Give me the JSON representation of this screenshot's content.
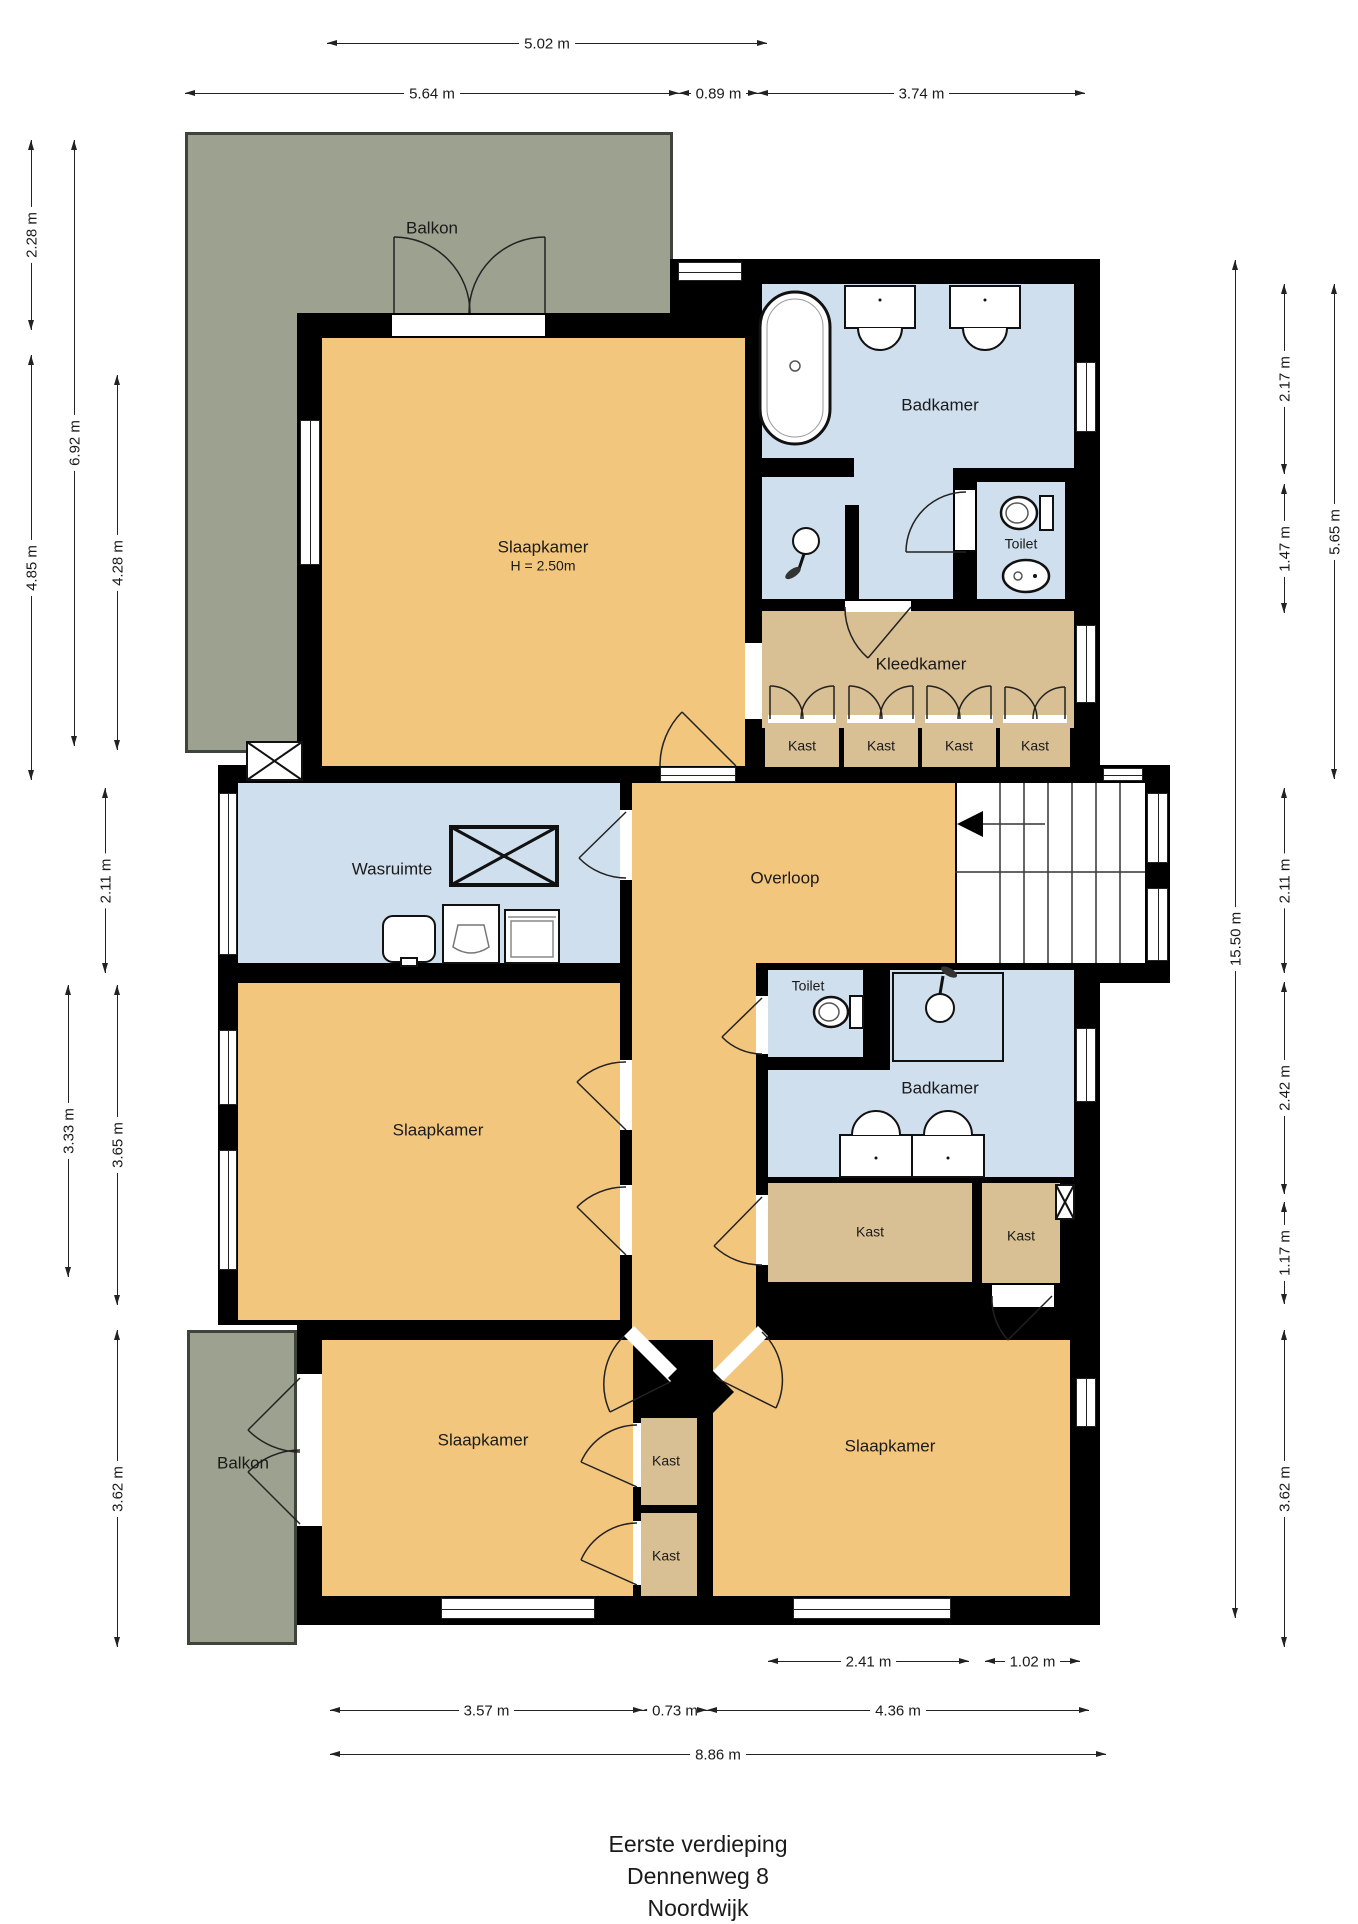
{
  "title": {
    "line1": "Eerste verdieping",
    "line2": "Dennenweg 8",
    "line3": "Noordwijk"
  },
  "rooms": {
    "balkon_top": {
      "label": "Balkon"
    },
    "slaapkamer_top": {
      "label": "Slaapkamer",
      "height_note": "H = 2.50m"
    },
    "badkamer_top": {
      "label": "Badkamer"
    },
    "toilet_top": {
      "label": "Toilet"
    },
    "kleedkamer": {
      "label": "Kleedkamer"
    },
    "kast_row": [
      "Kast",
      "Kast",
      "Kast",
      "Kast"
    ],
    "wasruimte": {
      "label": "Wasruimte"
    },
    "overloop": {
      "label": "Overloop"
    },
    "toilet_mid": {
      "label": "Toilet"
    },
    "badkamer_mid": {
      "label": "Badkamer"
    },
    "slaapkamer_left": {
      "label": "Slaapkamer"
    },
    "kast_mid_left": {
      "label": "Kast"
    },
    "kast_mid_right": {
      "label": "Kast"
    },
    "balkon_bottom": {
      "label": "Balkon"
    },
    "slaapkamer_bottom_left": {
      "label": "Slaapkamer"
    },
    "kast_bottom_1": {
      "label": "Kast"
    },
    "kast_bottom_2": {
      "label": "Kast"
    },
    "slaapkamer_bottom_right": {
      "label": "Slaapkamer"
    }
  },
  "dimensions": {
    "top": [
      "5.02 m",
      "5.64 m",
      "0.89 m",
      "3.74 m"
    ],
    "left": [
      "2.28 m",
      "6.92 m",
      "4.85 m",
      "4.28 m",
      "2.11 m",
      "3.33 m",
      "3.65 m",
      "3.62 m"
    ],
    "right": [
      "2.17 m",
      "5.65 m",
      "1.47 m",
      "2.11 m",
      "15.50 m",
      "2.42 m",
      "1.17 m",
      "3.62 m"
    ],
    "bottom": [
      "2.41 m",
      "1.02 m",
      "3.57 m",
      "0.73 m",
      "4.36 m",
      "8.86 m"
    ]
  },
  "colors": {
    "wall": "#000000",
    "bedroom": "#f3c67e",
    "bathroom": "#cfdfee",
    "closet": "#d9bf94",
    "balcony": "#9ca28f",
    "background": "#ffffff"
  }
}
